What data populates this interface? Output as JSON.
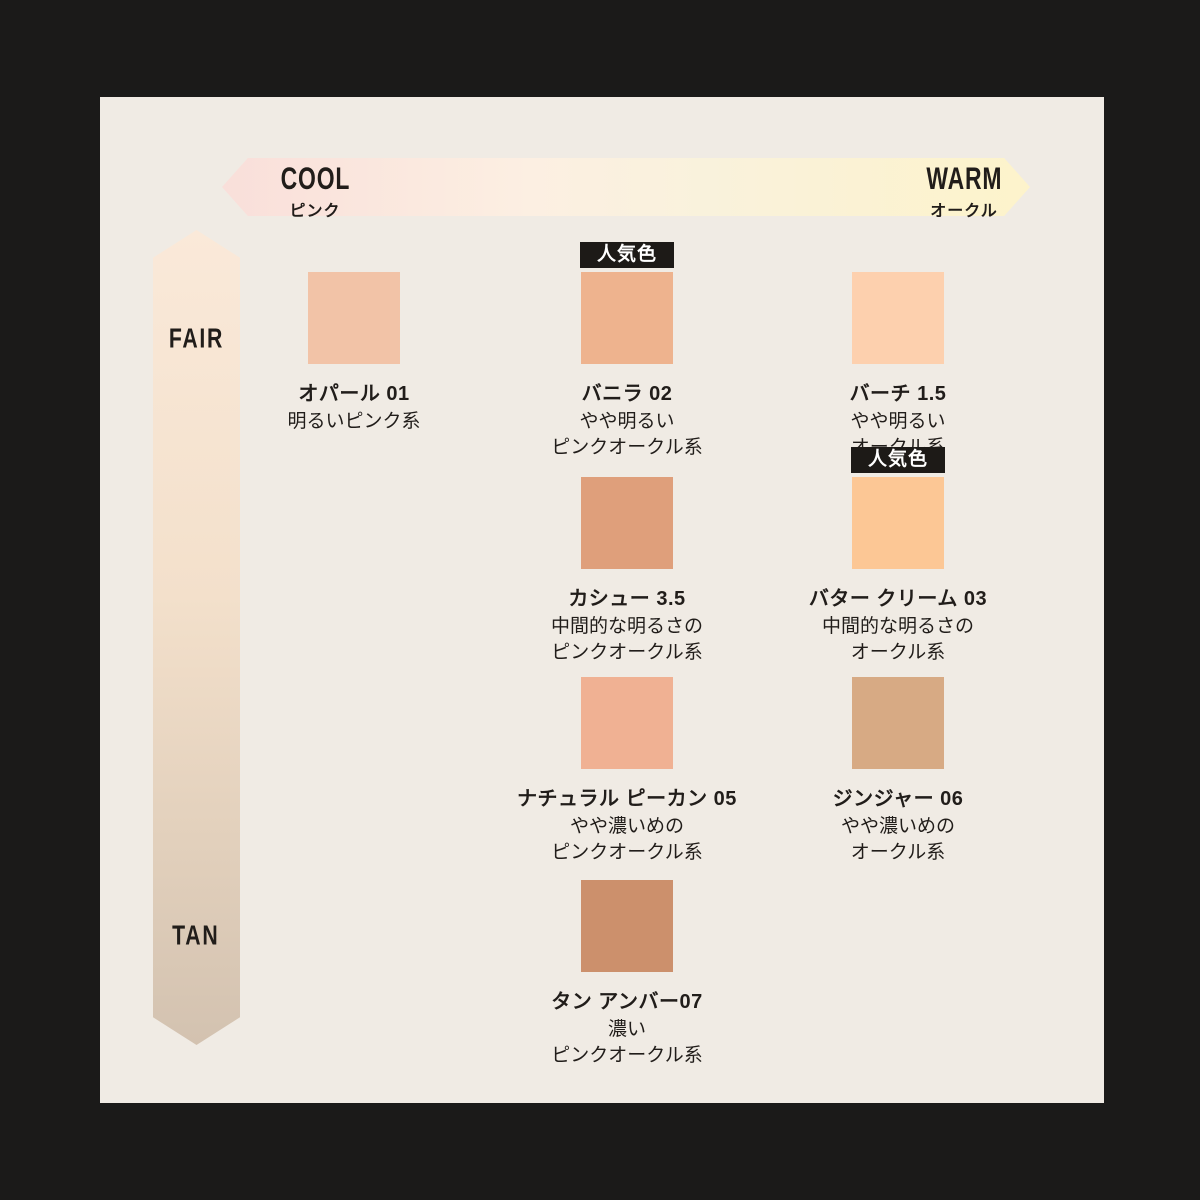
{
  "header": {
    "cool": {
      "label": "COOL",
      "sub": "ピンク"
    },
    "warm": {
      "label": "WARM",
      "sub": "オークル"
    }
  },
  "depth_axis": {
    "top": "FAIR",
    "bottom": "TAN"
  },
  "badge_label": "人気色",
  "colors": {
    "panel_bg": "#f0ebe4",
    "outer_bg": "#1b1a19",
    "badge_bg": "#1d1a17",
    "text": "#211d1a",
    "h_arrow_gradient": [
      "#f9dfda",
      "#fcefe2",
      "#f9f2dc",
      "#fdf3cb"
    ],
    "v_arrow_gradient": [
      "#fae9d9",
      "#d3c2b0"
    ]
  },
  "shades": [
    {
      "name": "オパール 01",
      "desc1": "明るいピンク系",
      "desc2": "",
      "color": "#f2c3a7",
      "popular": false
    },
    {
      "name": "バニラ 02",
      "desc1": "やや明るい",
      "desc2": "ピンクオークル系",
      "color": "#eeb38e",
      "popular": true
    },
    {
      "name": "バーチ 1.5",
      "desc1": "やや明るい",
      "desc2": "オークル系",
      "color": "#fdd0ae",
      "popular": false
    },
    {
      "name": "カシュー 3.5",
      "desc1": "中間的な明るさの",
      "desc2": "ピンクオークル系",
      "color": "#df9f7b",
      "popular": false
    },
    {
      "name": "バター クリーム 03",
      "desc1": "中間的な明るさの",
      "desc2": "オークル系",
      "color": "#fcc795",
      "popular": true
    },
    {
      "name": "ナチュラル ピーカン 05",
      "desc1": "やや濃いめの",
      "desc2": "ピンクオークル系",
      "color": "#f0b193",
      "popular": false
    },
    {
      "name": "ジンジャー 06",
      "desc1": "やや濃いめの",
      "desc2": "オークル系",
      "color": "#d7aa84",
      "popular": false
    },
    {
      "name": "タン アンバー07",
      "desc1": "濃い",
      "desc2": "ピンクオークル系",
      "color": "#cc906c",
      "popular": false
    }
  ]
}
